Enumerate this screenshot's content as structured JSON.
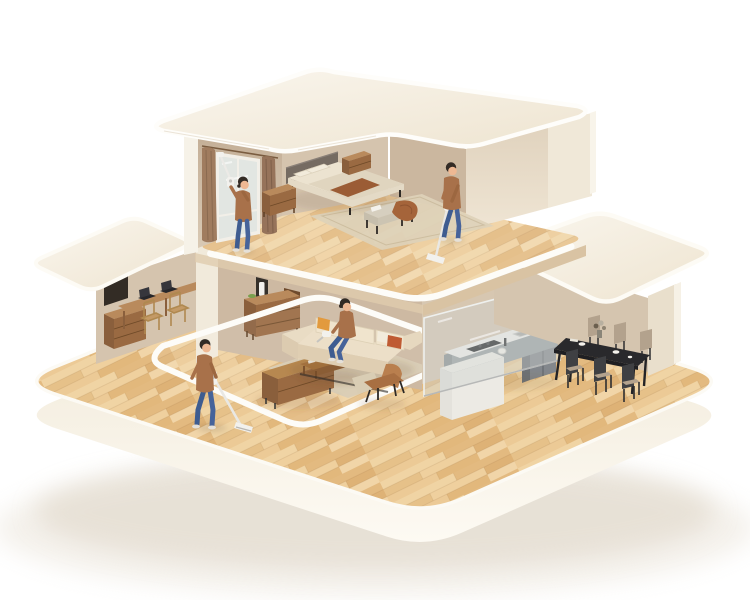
{
  "scene": {
    "name": "two-story-dollhouse-cutaway-cleaning-illustration",
    "floors": [
      {
        "name": "upper-floor",
        "rooms": [
          "bedroom"
        ],
        "objects": [
          "roof-slab",
          "window",
          "curtains",
          "bed",
          "headboard",
          "pillows",
          "duvet",
          "blanket-runner",
          "nightstand-left",
          "nightstand-right",
          "foot-bench",
          "throw-blanket",
          "area-rug",
          "wood-floor"
        ]
      },
      {
        "name": "ground-floor",
        "rooms": [
          "study",
          "living-room",
          "kitchen",
          "dining-room"
        ],
        "objects": [
          "study-desk",
          "laptops",
          "study-chairs",
          "drawer-cabinet",
          "wall-dock-vacuum",
          "bookshelf",
          "sideboard",
          "sectional-sofa",
          "sofa-pillows",
          "coffee-table",
          "tv-console",
          "armchair",
          "area-rug",
          "glass-partition",
          "kitchen-counter",
          "cooktop",
          "sink",
          "faucet",
          "fridge",
          "kitchen-island",
          "dining-table",
          "dining-chairs",
          "vase-with-flowers",
          "tableware",
          "wood-floor",
          "base-platform"
        ]
      }
    ],
    "people": [
      {
        "name": "person-window-cleaning",
        "activity": "cleaning-window-with-extension-vacuum",
        "location": "bedroom"
      },
      {
        "name": "person-vacuuming-upstairs",
        "activity": "stick-vacuum-cleaning",
        "location": "bedroom"
      },
      {
        "name": "person-vacuuming-downstairs",
        "activity": "stick-vacuum-cleaning",
        "location": "living-room"
      },
      {
        "name": "person-handheld-vacuuming",
        "activity": "handheld-vacuum-on-sofa",
        "location": "living-room"
      }
    ]
  },
  "palette": {
    "bg": "#ffffff",
    "shadow": "#ded5c6",
    "roof_rim": "#fdfcf6",
    "wall_deep": "#cdb9a2",
    "wall_warm": "#d5c4ae",
    "wall_notch": "#cbb79f",
    "wall_light": "#e9dcc8",
    "wall_lighter": "#f0e8d8",
    "wall_column": "#f1eadb",
    "kitchen_back_wall": "#d7c7b1",
    "dining_back_wall": "#d5c5af",
    "right_support_wall": "#e9dfcc",
    "niche_dark": "#332c25",
    "window_glass": "#e2e6e2",
    "window_frame": "#f2efe8",
    "curtain_left": "#a07c5f",
    "curtain_right": "#96735a",
    "headboard": "#756b62",
    "bedding": "#ece3d0",
    "duvet": "#e0d5bf",
    "blanket_brown": "#9b5c35",
    "wood_furniture": "#9a6a42",
    "wood_furniture_dark": "#8a5f3c",
    "wood_furniture_top": "#b98a5c",
    "bench_cushion": "#d6cfbf",
    "rug": "#ded2b9",
    "rug_living": "#d9cdb6",
    "sofa": "#ecdfc8",
    "sofa_front": "#dfceb2",
    "pillow_orange": "#e29a3e",
    "pillow_rust": "#bf5b33",
    "armchair": "#b97f4e",
    "kitchen_gray": "#9aa0a2",
    "kitchen_dark_gray": "#83878c",
    "counter_white": "#f3f2ee",
    "cooktop_black": "#1d1e20",
    "glass": "#ccd2d0",
    "table_black": "#29292c",
    "chair_tan": "#b3a28d",
    "chair_dark": "#3f4043",
    "island_white": "#f1efe9",
    "skin": "#eeb893",
    "hair": "#332b25",
    "sweater": "#a8714a",
    "jeans": "#3e5c90",
    "vacuum_white": "#f2f1ed",
    "vacuum_gray": "#c5c4c0",
    "shoe": "#e5e0d8"
  }
}
